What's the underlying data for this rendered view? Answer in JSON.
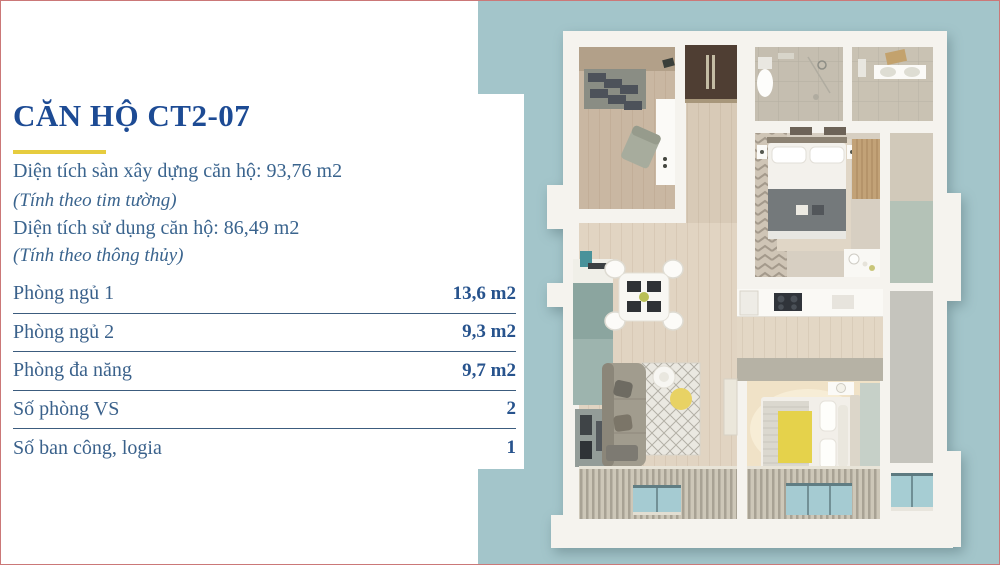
{
  "page": {
    "background": "#ffffff",
    "frame_border_color": "#cb7878",
    "panel_teal_color": "#a3c5ca"
  },
  "header": {
    "title": "CĂN HỘ CT2-07",
    "title_color": "#1d4b94",
    "underline_color": "#e6cc3e"
  },
  "summary": {
    "built_area": "Diện tích sàn xây dựng căn hộ: 93,76 m2",
    "built_area_note": "(Tính theo tim tường)",
    "usable_area": "Diện tích sử dụng căn hộ: 86,49 m2",
    "usable_area_note": "(Tính theo thông thủy)",
    "text_color": "#3a648e"
  },
  "table": {
    "separator_color": "#3c5c7e",
    "rows": [
      {
        "label": "Phòng ngủ 1",
        "value": "13,6 m2"
      },
      {
        "label": "Phòng ngủ 2",
        "value": "9,3 m2"
      },
      {
        "label": "Phòng đa năng",
        "value": "9,7 m2"
      },
      {
        "label": "Số phòng VS",
        "value": "2"
      },
      {
        "label": "Số ban công, logia",
        "value": "1"
      }
    ]
  },
  "floorplan": {
    "kind": "3d-top-down-apartment-render",
    "rooms": [
      "kitchen",
      "entry-hall",
      "bathroom-1",
      "bathroom-2",
      "bedroom-1",
      "bedroom-2",
      "living-dining",
      "multi-purpose-room",
      "balcony-loggia"
    ]
  }
}
